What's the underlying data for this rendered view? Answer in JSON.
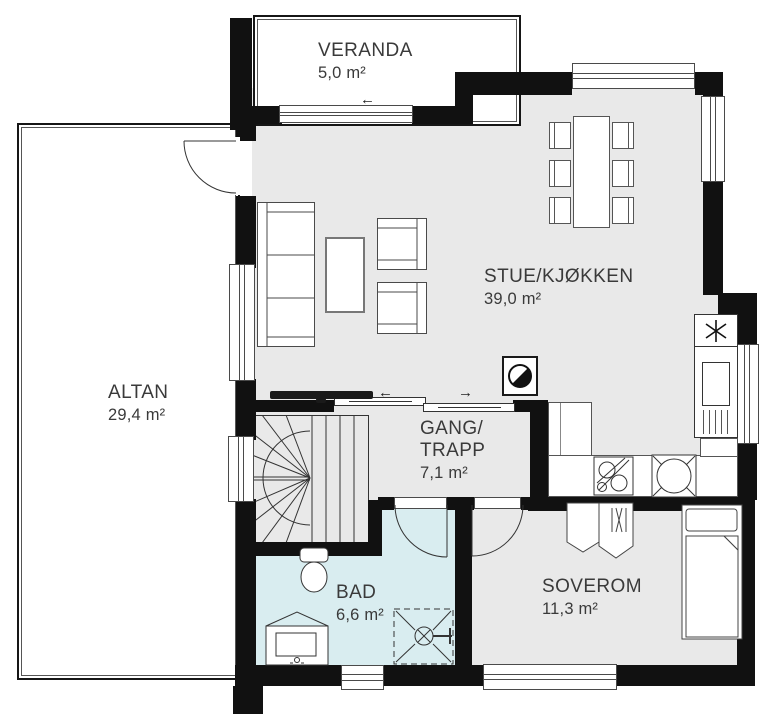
{
  "plan_type": "floor-plan",
  "rooms": {
    "veranda": {
      "name": "VERANDA",
      "area": "5,0 m²"
    },
    "altan": {
      "name": "ALTAN",
      "area": "29,4 m²"
    },
    "stue_kjokken": {
      "name": "STUE/KJØKKEN",
      "area": "39,0 m²"
    },
    "gang_trapp": {
      "name_line1": "GANG/",
      "name_line2": "TRAPP",
      "area": "7,1 m²"
    },
    "bad": {
      "name": "BAD",
      "area": "6,6 m²"
    },
    "soverom": {
      "name": "SOVEROM",
      "area": "11,3 m²"
    }
  },
  "annotations": {
    "veranda_slider_arrow": "←",
    "stue_slider_arrow_left": "←",
    "stue_slider_arrow_right": "→"
  },
  "symbols": {
    "fridge": "snowflake-icon",
    "fireplace": "half-filled-circle-icon",
    "stove": "round-hob-icon",
    "kitchen_sink": "double-basin-icon",
    "shower": "dashed-enclosure-with-mixer"
  },
  "colors": {
    "wall": "#111111",
    "interior_floor": "#e9e9e9",
    "bathroom_floor": "#d9edf0",
    "outdoor_floor": "#ffffff",
    "furniture_outline": "#4a4a4a",
    "label_text": "#3a3a3a"
  }
}
